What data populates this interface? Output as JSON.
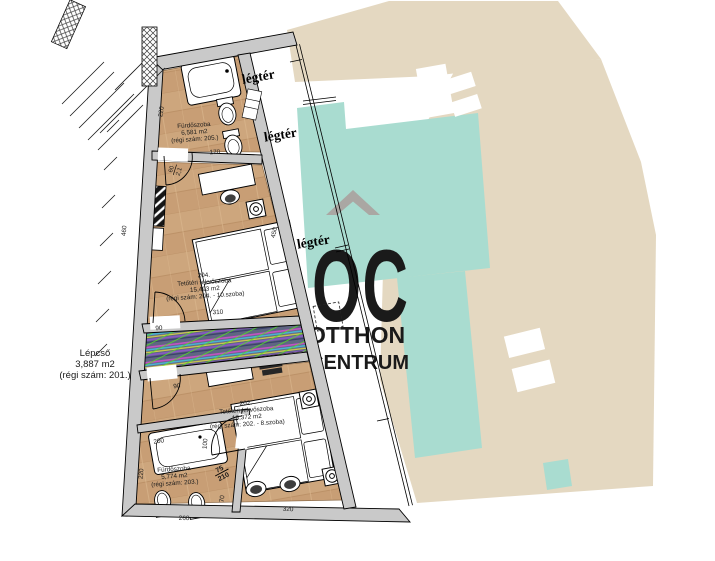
{
  "plan": {
    "legter": [
      "légtér",
      "légtér",
      "légtér"
    ],
    "stairwell": {
      "name": "Lépcső",
      "area": "3,887 m2",
      "old_number": "(régi szám: 201.)"
    },
    "bathroom_top": {
      "name": "Fürdőszoba",
      "area": "6,581 m2",
      "old_number": "(régi szám: 205.)"
    },
    "room_204": {
      "number": "204.",
      "name": "Tetőtéri fekvőszoba",
      "area": "15,493 m2",
      "old_number": "(régi szám: 204. - 10.szoba)"
    },
    "room_202": {
      "number": "202.",
      "name": "Tetőtéri fekvőszoba",
      "area": "16,372 m2",
      "old_number": "(régi szám: 202. - 8.szoba)"
    },
    "bathroom_bottom": {
      "name": "Fürdőszoba",
      "area": "5,774 m2",
      "old_number": "(régi szám: 203.)"
    },
    "doors": {
      "door_204": {
        "width": "60",
        "height": "2,1"
      },
      "door_203": {
        "width": "75",
        "height": "210"
      }
    },
    "dimensions": {
      "bath_top_side": "220",
      "bath_top_wall": "170",
      "left_wall": "460",
      "stair_opening_top": "90",
      "stair_opening_bottom": "90",
      "stair_length": "310",
      "airspace_wall": "450",
      "bath_bottom_top": "200",
      "bath_bottom_right": "100",
      "bath_bottom_side": "220",
      "bath_bottom_lower": "70",
      "bottom_edge_left": "260",
      "bottom_edge_right": "320"
    }
  },
  "watermark": {
    "monogram": "OC",
    "word_top": "OTTHON",
    "word_bottom": "CENTRUM"
  },
  "colors": {
    "wall_gray": "#c9c9c9",
    "floor_wood": "#c89e75",
    "roof_beige": "#e4d8c1",
    "roof_teal": "#a9dcd0",
    "watermark_gray": "#aaa7a3",
    "stair_hatch_green": "#55e71d"
  }
}
